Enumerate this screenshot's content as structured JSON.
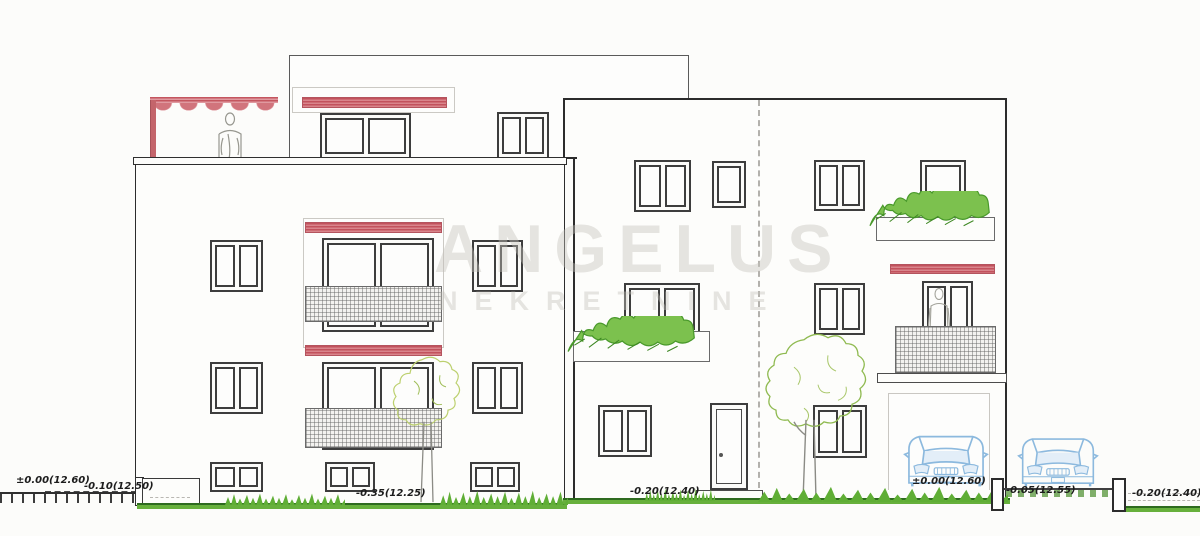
{
  "watermark": {
    "primary": "ANGELUS",
    "secondary": "NEKRETNINE"
  },
  "elevation_labels": {
    "street_left_zero": "±0.00(12.60)",
    "street_left_drop": "-0.10(12.50)",
    "left_building_base": "-0.35(12.25)",
    "right_building_base": "-0.20(12.40)",
    "garage_level": "±0.00(12.60)",
    "driveway_level": "-0.05(12.55)",
    "street_right_drop": "-0.20(12.40)"
  },
  "colors": {
    "awning_red": "#c2525d",
    "grass_green": "#5fae35",
    "foliage_green": "#7cc14e",
    "tree_outline": "#9ebf5a",
    "car_blue": "#8cb9de",
    "line_dark": "#2c2c2c",
    "watermark_gray": "#e7e6e2"
  }
}
